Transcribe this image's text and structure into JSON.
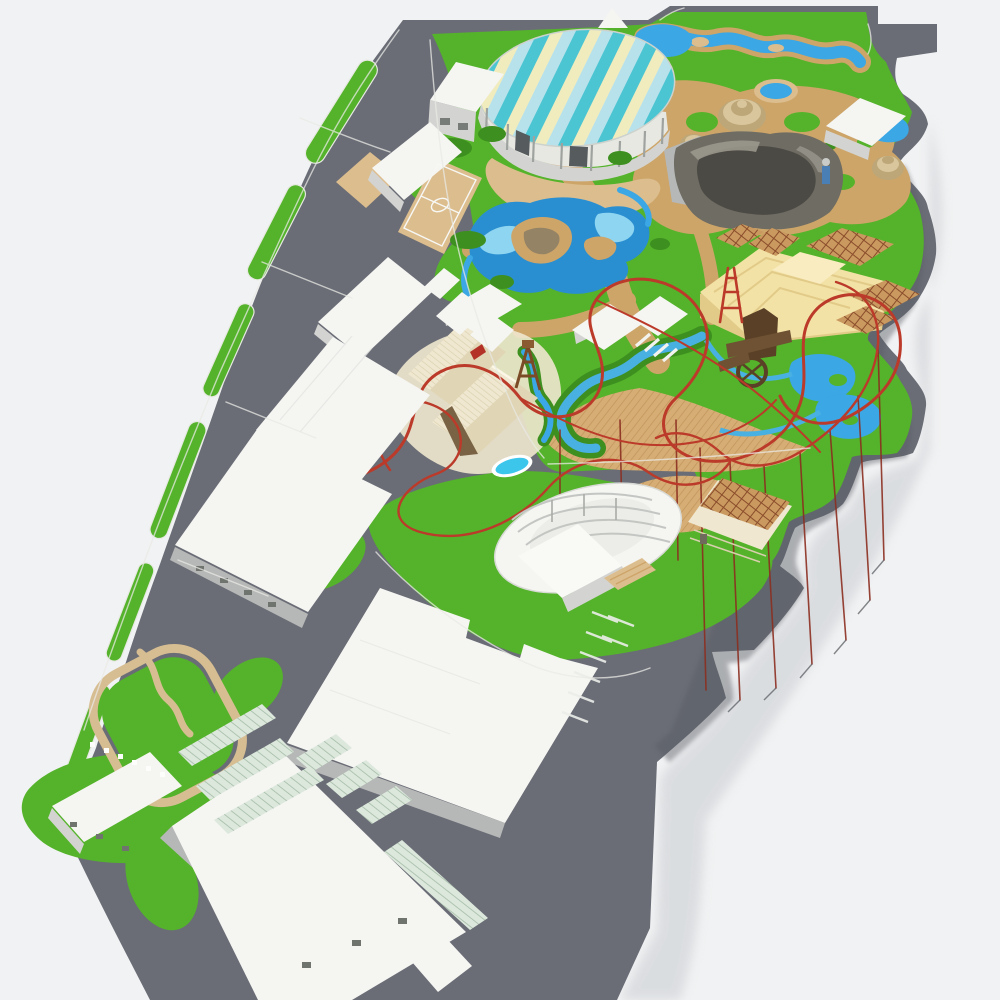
{
  "scene": {
    "kind": "3d-aerial-render-theme-park-master-plan",
    "features": [
      "striped-dome-pavilion",
      "wave-pool-river",
      "round-pool",
      "stupa-towers",
      "rock-mountain",
      "poolside-pavilion",
      "central-lake",
      "roller-coaster-track",
      "western-fort",
      "rapids-river",
      "water-mill",
      "temple-platform",
      "pergola-lattice-roofs",
      "timber-deck",
      "amphitheater",
      "trellis-pavilion",
      "warehouse-row",
      "basketball-court",
      "parking-lot",
      "greenhouse-rows",
      "stable-and-paddock",
      "service-roads"
    ]
  },
  "palette": {
    "bg": "#f1f2f3",
    "asphalt": "#6a6d76",
    "asphalt_shadow": "#595c63",
    "curb": "#e9eae5",
    "grass": "#54b32a",
    "grass_dark": "#3d8f1f",
    "grass_light": "#7fca4f",
    "sand": "#cda569",
    "sand_light": "#dcbd8e",
    "water": "#3ba7e4",
    "water_deep": "#2a8fd0",
    "water_light": "#8ed5f2",
    "pool_cyan": "#3cc6ec",
    "white_roof": "#f5f5f2",
    "white_side": "#d3d4d1",
    "white_side_dark": "#b6b8b7",
    "cream": "#efe7cf",
    "beige": "#f3e2a6",
    "beige_side": "#e2cb89",
    "lattice": "#955330",
    "wood": "#5a4026",
    "rock": "#4c4a44",
    "rock_mid": "#6e6c63",
    "rock_light": "#9a988d",
    "stupa": "#d9c69c",
    "stupa_dark": "#bda778",
    "coaster": "#bb3a2a",
    "coaster_support": "#8c2f21"
  }
}
